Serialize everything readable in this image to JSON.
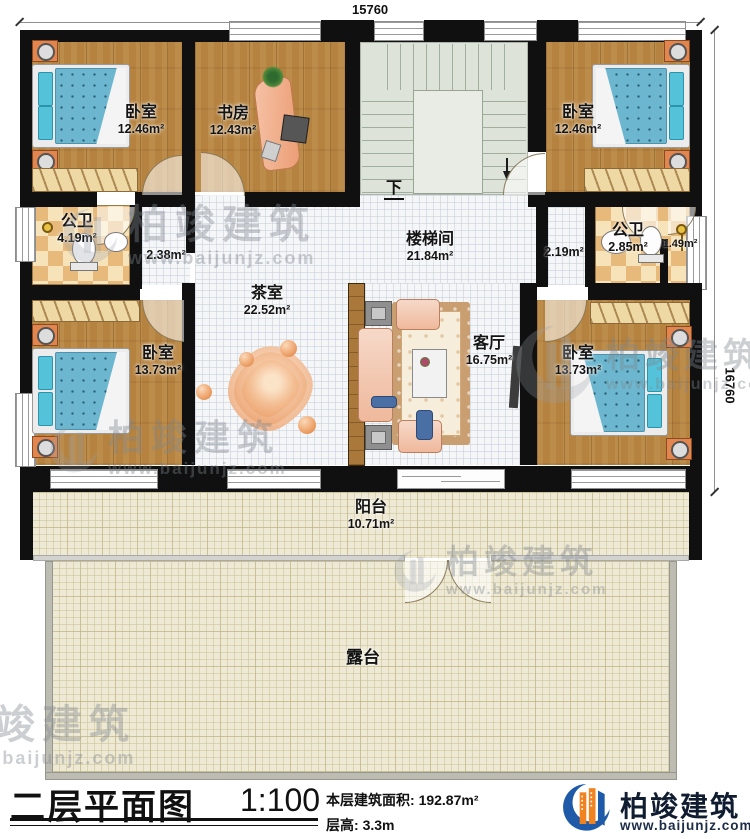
{
  "palette": {
    "wall": "#101010",
    "wood_floor": "#b5823f",
    "bath_tile_light": "#f6e3ba",
    "bath_tile_dark": "#e7ba7c",
    "hall_tile": "#f5f6f8",
    "stair": "#dde3d9",
    "bed_blue": "#6cb7cf",
    "pillow_teal": "#54c2d8",
    "terrace_cream": "#eee9d4",
    "table_orange": "#e8945c",
    "brand_blue": "#1e5aa8",
    "brand_orange": "#f08220"
  },
  "dimensions": {
    "top_width": "15760",
    "right_height": "16760"
  },
  "rooms": {
    "bedroom_tl": {
      "name": "卧室",
      "area": "12.46m²"
    },
    "study": {
      "name": "书房",
      "area": "12.43m²"
    },
    "bedroom_tr": {
      "name": "卧室",
      "area": "12.46m²"
    },
    "bath_left": {
      "name": "公卫",
      "area": "4.19m²"
    },
    "hall_left": {
      "area": "2.38m²"
    },
    "stairwell": {
      "name": "楼梯间",
      "area": "21.84m²",
      "down_label": "下"
    },
    "hall_right": {
      "area": "2.19m²"
    },
    "bath_right": {
      "name": "公卫",
      "area": "2.85m²"
    },
    "shower": {
      "area": "1.49m²"
    },
    "tea_room": {
      "name": "茶室",
      "area": "22.52m²"
    },
    "living_room": {
      "name": "客厅",
      "area": "16.75m²"
    },
    "bedroom_bl": {
      "name": "卧室",
      "area": "13.73m²"
    },
    "bedroom_br": {
      "name": "卧室",
      "area": "13.73m²"
    },
    "balcony": {
      "name": "阳台",
      "area": "10.71m²"
    },
    "terrace": {
      "name": "露台"
    }
  },
  "watermark": {
    "brand": "柏竣建筑",
    "url": "www.baijunjz.com"
  },
  "footer": {
    "title": "二层平面图",
    "scale": "1:100",
    "area_label": "本层建筑面积:",
    "area_value": "192.87m²",
    "floor_height_label": "层高:",
    "floor_height_value": "3.3m",
    "brand": "柏竣建筑",
    "brand_url": "www.baijunjz.com"
  }
}
